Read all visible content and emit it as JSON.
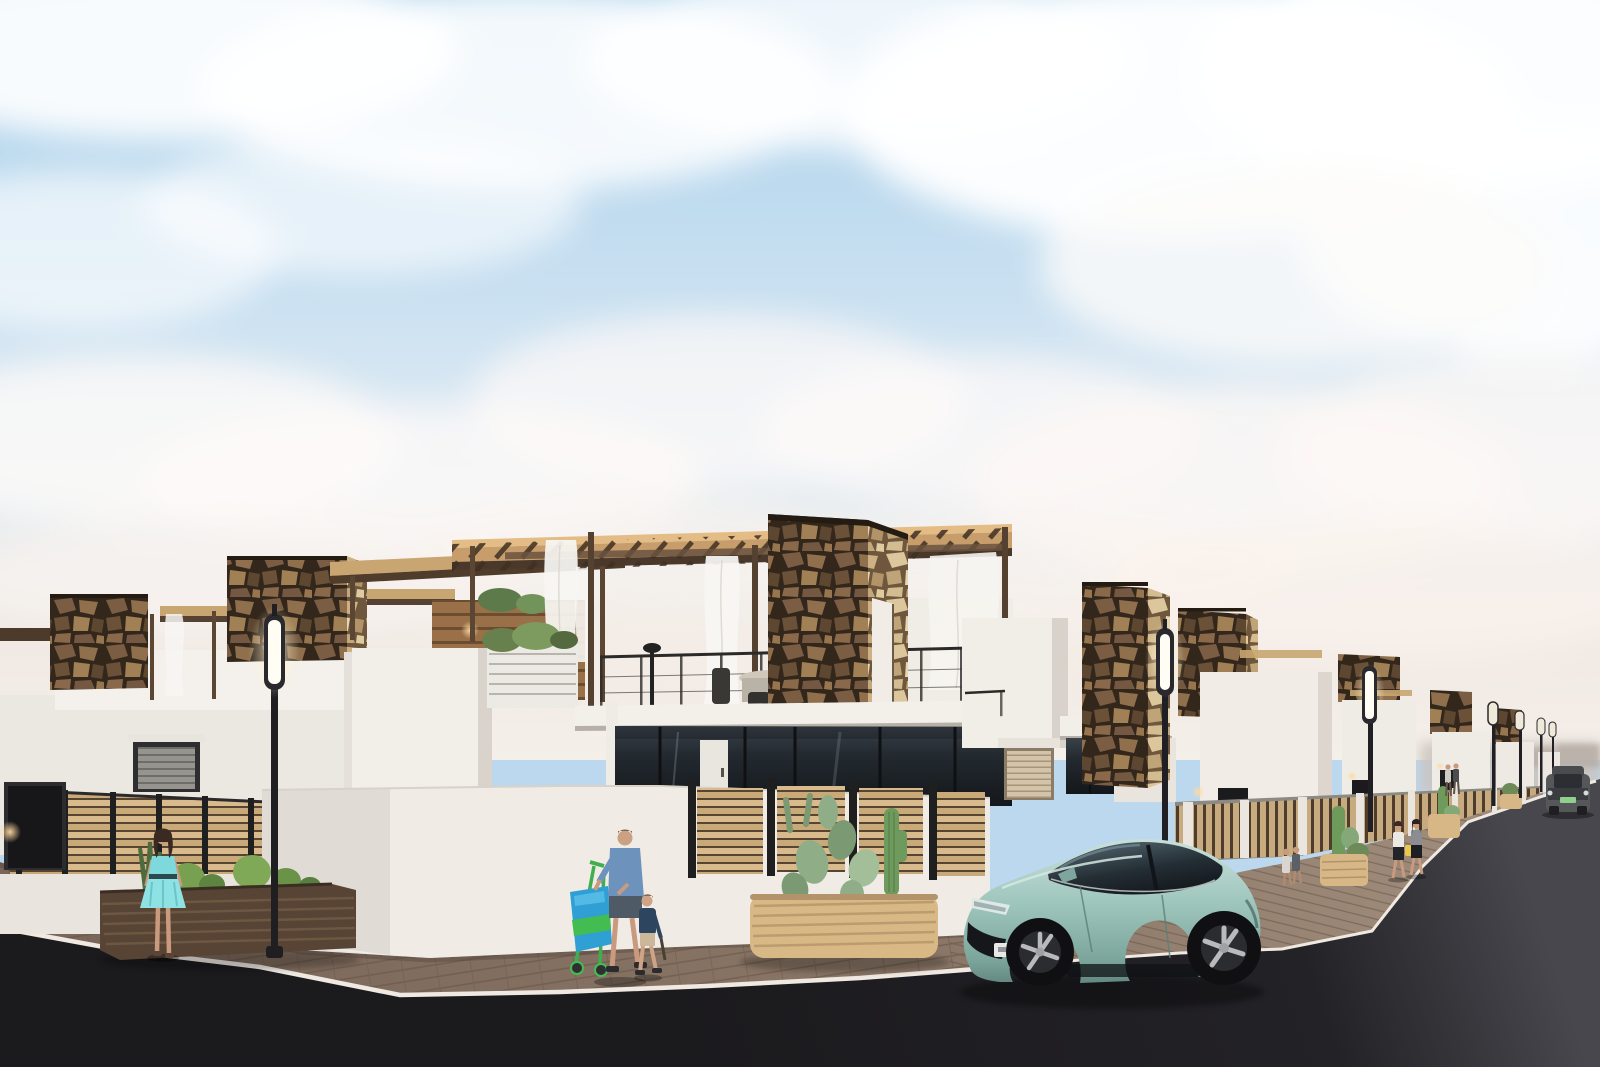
{
  "meta": {
    "kind": "architectural-render",
    "width": 1600,
    "height": 1067,
    "description": "Street-corner render of a new-build development: white modern villas with irregular stone-clad towers, rooftop wood pergolas with white curtains, roof terraces with cable railings and outdoor furniture, wood slat fences, cacti planters, street lamps, pedestrians, a man pushing a shopping trolley with a child, two women walking, a distant gray SUV, and a light-teal sedan parked on a dark asphalt street under a blue sky with fluffy clouds."
  },
  "palette": {
    "sky_top": "#a9d0ea",
    "sky_mid": "#dfeaf3",
    "sky_horizon": "#f3ece5",
    "cloud": "#ffffff",
    "wall_white": "#f2efe9",
    "wall_shade": "#d9d3cb",
    "stone_dark_bg": "#33271c",
    "stone_light_bg": "#6e573c",
    "pergola_wood": "#cfa977",
    "pergola_under": "#4a392a",
    "fence_wood": "#d3b488",
    "plank_wood": "#9a7049",
    "planter_dark": "#574434",
    "planter_light": "#d8b885",
    "glass_dark": "#161b20",
    "road": "#1b1a1d",
    "road_far": "#45454b",
    "sidewalk": "#7b675a",
    "curb": "#efe9e2",
    "car_teal": "#9ec6bd",
    "car_glass": "#2c3a42",
    "lamp_glow": "#fff9e6",
    "wall_lamp_warm": "#ffc98a",
    "cactus": "#6e9a5c",
    "trolley_blue": "#2f9fd4",
    "trolley_green": "#43bd52",
    "dress_aqua": "#7ed9dc",
    "shirt_blue": "#6d93bd",
    "suv_gray": "#55575a",
    "plate_green": "#8fd08a",
    "skin": "#c99a7e"
  },
  "objects": {
    "sky": {
      "label": "blue sky with scattered clouds"
    },
    "clouds": {
      "label": "white cumulus clouds"
    },
    "horizon_haze": {
      "label": "hazy distant skyline at street vanishing point"
    },
    "road": {
      "label": "dark asphalt street"
    },
    "sidewalk": {
      "label": "brick-paved sidewalk curving around the corner"
    },
    "curb": {
      "label": "white curb line"
    },
    "left_villa": {
      "label": "white villa block with stone towers on left street"
    },
    "left_garage_door": {
      "label": "gray roller garage door"
    },
    "left_door": {
      "label": "dark entrance door at far left"
    },
    "left_fence": {
      "label": "horizontal wood slat fence with black posts"
    },
    "left_planter": {
      "label": "dark wood planter with shrubs and agave"
    },
    "woman_aqua": {
      "label": "woman in turquoise dress"
    },
    "street_lamp_1": {
      "label": "street lamp"
    },
    "street_lamp_2": {
      "label": "street lamp"
    },
    "street_lamp_3": {
      "label": "street lamp"
    },
    "distant_lamps": {
      "label": "distant street lamps"
    },
    "neighbor_pergola": {
      "label": "wood-clad rooftop with pergola and warm lights"
    },
    "main_villa": {
      "label": "two-storey white villa"
    },
    "main_pergola": {
      "label": "rooftop wooden pergola with white curtains"
    },
    "roof_terrace": {
      "label": "roof terrace with cable railing"
    },
    "terrace_furniture": {
      "label": "outdoor dining furniture silhouette"
    },
    "main_stone_tower": {
      "label": "stone-clad tower with warm wall light"
    },
    "canopy": {
      "label": "white ground-floor canopy slab"
    },
    "glazing": {
      "label": "full-height dark glazing with white door"
    },
    "perimeter_wall": {
      "label": "curved white perimeter wall"
    },
    "slat_fence": {
      "label": "wood slat fence panels on perimeter wall"
    },
    "cacti_planter": {
      "label": "light wood planter with prickly pear and columnar cactus"
    },
    "man_trolley": {
      "label": "man in blue shirt pushing shopping trolley"
    },
    "child": {
      "label": "child walking beside the man"
    },
    "trolley": {
      "label": "blue and green shopping trolley"
    },
    "right_villa": {
      "label": "white villa with stone towers and beige roller garage"
    },
    "right_garage_door": {
      "label": "beige roller garage door"
    },
    "receding_villas": {
      "label": "row of white villas receding down the right street"
    },
    "right_fence": {
      "label": "street-side wood fence with white piers"
    },
    "right_planters": {
      "label": "wooden planters with cacti along sidewalk"
    },
    "women_walking": {
      "label": "two women walking on the sidewalk"
    },
    "pedestrians_mid": {
      "label": "pedestrians behind the parked car"
    },
    "pedestrians_far": {
      "label": "distant pedestrians"
    },
    "distant_suv": {
      "label": "gray SUV with green license plate driving in distance"
    },
    "car": {
      "label": "light teal sedan parked at the curb with illegible license plate"
    }
  }
}
